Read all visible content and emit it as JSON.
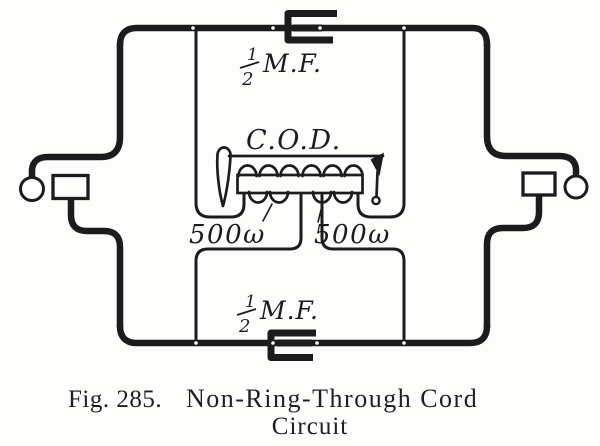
{
  "figure": {
    "colors": {
      "ink": "#1c1c1c",
      "paper": "#fdfdfc"
    },
    "labels": {
      "capacitor_top": {
        "numerator": "1",
        "denominator": "2",
        "unit": "M.F."
      },
      "capacitor_bottom": {
        "numerator": "1",
        "denominator": "2",
        "unit": "M.F."
      },
      "coil": "C.O.D.",
      "winding_left": "500ω",
      "winding_right": "500ω"
    },
    "caption": {
      "fig_label": "Fig. 285.",
      "title_line1": "Non-Ring-Through Cord",
      "title_line2": "Circuit"
    }
  }
}
